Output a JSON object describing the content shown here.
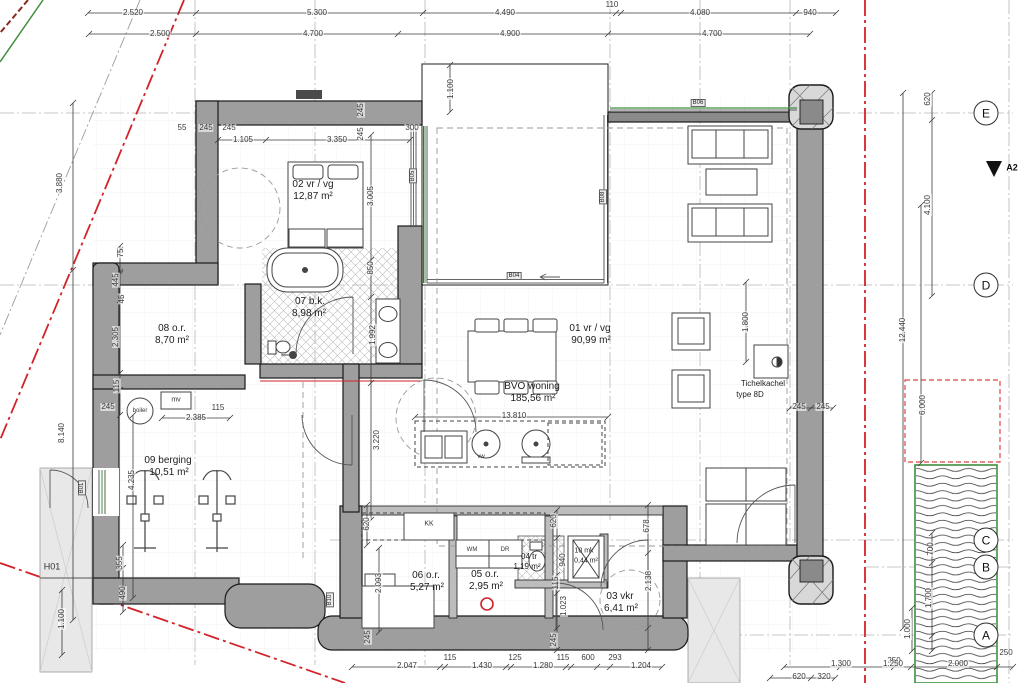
{
  "drawing": {
    "type": "architectural-floor-plan",
    "grid_axes": [
      "E",
      "D",
      "C",
      "B",
      "A"
    ],
    "section_marker": "A2",
    "window_tags": [
      "B01",
      "B04",
      "B05",
      "B06",
      "B08",
      "B10"
    ],
    "colors": {
      "boundary_red": "#d2232a",
      "vegetation_green": "#3d8f3d",
      "wall_grey": "#9e9e9e"
    },
    "rooms": [
      {
        "number": "01",
        "label": "vr / vg",
        "area": "90,99 m²"
      },
      {
        "number": "02",
        "label": "vr / vg",
        "area": "12,87 m²"
      },
      {
        "number": "03",
        "label": "vkr",
        "area": "6,41 m²"
      },
      {
        "number": "04",
        "label": "tr",
        "area": "1,19 m²"
      },
      {
        "number": "05",
        "label": "o.r.",
        "area": "2,95 m²"
      },
      {
        "number": "06",
        "label": "o.r.",
        "area": "5,27 m²"
      },
      {
        "number": "07",
        "label": "b.k.",
        "area": "8,98 m²"
      },
      {
        "number": "08",
        "label": "o.r.",
        "area": "8,70 m²"
      },
      {
        "number": "09",
        "label": "berging",
        "area": "10,51 m²"
      },
      {
        "number": "10",
        "label": "mk",
        "area": "0,44 m²"
      },
      {
        "number": "BVO",
        "label": "woning",
        "area": "185,56 m²"
      }
    ],
    "annotations": [
      {
        "t": "2.520",
        "x": 133,
        "y": 13,
        "k": "dim"
      },
      {
        "t": "5.300",
        "x": 317,
        "y": 13,
        "k": "dim"
      },
      {
        "t": "4.490",
        "x": 505,
        "y": 13,
        "k": "dim"
      },
      {
        "t": "110",
        "x": 612,
        "y": 5,
        "k": "dim"
      },
      {
        "t": "4.080",
        "x": 700,
        "y": 13,
        "k": "dim"
      },
      {
        "t": "940",
        "x": 810,
        "y": 13,
        "k": "dim"
      },
      {
        "t": "2.500",
        "x": 160,
        "y": 34,
        "k": "dim"
      },
      {
        "t": "4.700",
        "x": 313,
        "y": 34,
        "k": "dim"
      },
      {
        "t": "4.900",
        "x": 510,
        "y": 34,
        "k": "dim"
      },
      {
        "t": "4.700",
        "x": 712,
        "y": 34,
        "k": "dim"
      },
      {
        "t": "620",
        "x": 928,
        "y": 99,
        "k": "dim",
        "r": 1
      },
      {
        "t": "4.100",
        "x": 928,
        "y": 205,
        "k": "dim",
        "r": 1
      },
      {
        "t": "12.440",
        "x": 903,
        "y": 330,
        "k": "dim",
        "r": 1
      },
      {
        "t": "6.000",
        "x": 923,
        "y": 405,
        "k": "dim",
        "r": 1
      },
      {
        "t": "700",
        "x": 931,
        "y": 549,
        "k": "dim",
        "r": 1
      },
      {
        "t": "1.700",
        "x": 929,
        "y": 598,
        "k": "dim",
        "r": 1
      },
      {
        "t": "1.000",
        "x": 908,
        "y": 629,
        "k": "dim",
        "r": 1
      },
      {
        "t": "250",
        "x": 894,
        "y": 661,
        "k": "dim"
      },
      {
        "t": "2.000",
        "x": 958,
        "y": 664,
        "k": "dim"
      },
      {
        "t": "250",
        "x": 1006,
        "y": 653,
        "k": "dim"
      },
      {
        "t": "1.300",
        "x": 841,
        "y": 664,
        "k": "dim"
      },
      {
        "t": "1.250",
        "x": 893,
        "y": 664,
        "k": "dim"
      },
      {
        "t": "620",
        "x": 799,
        "y": 677,
        "k": "dim"
      },
      {
        "t": "320",
        "x": 824,
        "y": 677,
        "k": "dim"
      },
      {
        "t": "3.880",
        "x": 60,
        "y": 183,
        "k": "dim",
        "r": 1
      },
      {
        "t": "8.140",
        "x": 62,
        "y": 433,
        "k": "dim",
        "r": 1
      },
      {
        "t": "75",
        "x": 121,
        "y": 253,
        "k": "dim",
        "r": 1
      },
      {
        "t": "445",
        "x": 116,
        "y": 280,
        "k": "dim",
        "r": 1
      },
      {
        "t": "45",
        "x": 122,
        "y": 299,
        "k": "dim",
        "r": 1
      },
      {
        "t": "2.305",
        "x": 116,
        "y": 337,
        "k": "dim",
        "r": 1
      },
      {
        "t": "115",
        "x": 117,
        "y": 386,
        "k": "dim",
        "r": 1
      },
      {
        "t": "245",
        "x": 108,
        "y": 407,
        "k": "dim"
      },
      {
        "t": "2.385",
        "x": 196,
        "y": 418,
        "k": "dim"
      },
      {
        "t": "115",
        "x": 218,
        "y": 408,
        "k": "dim"
      },
      {
        "t": "4.235",
        "x": 132,
        "y": 480,
        "k": "dim",
        "r": 1
      },
      {
        "t": "355",
        "x": 120,
        "y": 563,
        "k": "dim",
        "r": 1
      },
      {
        "t": "490",
        "x": 123,
        "y": 593,
        "k": "dim",
        "r": 1
      },
      {
        "t": "1.100",
        "x": 62,
        "y": 619,
        "k": "dim",
        "r": 1
      },
      {
        "t": "55",
        "x": 182,
        "y": 128,
        "k": "dim"
      },
      {
        "t": "245",
        "x": 206,
        "y": 128,
        "k": "dim"
      },
      {
        "t": "245",
        "x": 229,
        "y": 128,
        "k": "dim"
      },
      {
        "t": "1.105",
        "x": 243,
        "y": 140,
        "k": "dim"
      },
      {
        "t": "3.350",
        "x": 337,
        "y": 140,
        "k": "dim"
      },
      {
        "t": "245",
        "x": 361,
        "y": 110,
        "k": "dim",
        "r": 1
      },
      {
        "t": "245",
        "x": 361,
        "y": 134,
        "k": "dim",
        "r": 1
      },
      {
        "t": "300",
        "x": 412,
        "y": 128,
        "k": "dim"
      },
      {
        "t": "1.100",
        "x": 451,
        "y": 89,
        "k": "dim",
        "r": 1
      },
      {
        "t": "3.005",
        "x": 371,
        "y": 196,
        "k": "dim",
        "r": 1
      },
      {
        "t": "850",
        "x": 371,
        "y": 268,
        "k": "dim",
        "r": 1
      },
      {
        "t": "1.992",
        "x": 373,
        "y": 335,
        "k": "dim",
        "r": 1
      },
      {
        "t": "3.220",
        "x": 377,
        "y": 440,
        "k": "dim",
        "r": 1
      },
      {
        "t": "13.810",
        "x": 514,
        "y": 416,
        "k": "dim"
      },
      {
        "t": "1.800",
        "x": 746,
        "y": 322,
        "k": "dim",
        "r": 1
      },
      {
        "t": "245",
        "x": 799,
        "y": 407,
        "k": "dim"
      },
      {
        "t": "245",
        "x": 823,
        "y": 407,
        "k": "dim"
      },
      {
        "t": "620",
        "x": 367,
        "y": 524,
        "k": "dim",
        "r": 1
      },
      {
        "t": "620",
        "x": 554,
        "y": 521,
        "k": "dim",
        "r": 1
      },
      {
        "t": "678",
        "x": 647,
        "y": 526,
        "k": "dim",
        "r": 1
      },
      {
        "t": "2.093",
        "x": 379,
        "y": 583,
        "k": "dim",
        "r": 1
      },
      {
        "t": "2.138",
        "x": 649,
        "y": 581,
        "k": "dim",
        "r": 1
      },
      {
        "t": "940",
        "x": 563,
        "y": 560,
        "k": "dim",
        "r": 1
      },
      {
        "t": "115",
        "x": 556,
        "y": 583,
        "k": "dim",
        "r": 1
      },
      {
        "t": "1.023",
        "x": 564,
        "y": 606,
        "k": "dim",
        "r": 1
      },
      {
        "t": "245",
        "x": 368,
        "y": 637,
        "k": "dim",
        "r": 1
      },
      {
        "t": "245",
        "x": 554,
        "y": 640,
        "k": "dim",
        "r": 1
      },
      {
        "t": "2.047",
        "x": 407,
        "y": 666,
        "k": "dim"
      },
      {
        "t": "115",
        "x": 450,
        "y": 658,
        "k": "dim"
      },
      {
        "t": "1.430",
        "x": 482,
        "y": 666,
        "k": "dim"
      },
      {
        "t": "125",
        "x": 515,
        "y": 658,
        "k": "dim"
      },
      {
        "t": "1.280",
        "x": 543,
        "y": 666,
        "k": "dim"
      },
      {
        "t": "115",
        "x": 563,
        "y": 658,
        "k": "dim"
      },
      {
        "t": "600",
        "x": 588,
        "y": 658,
        "k": "dim"
      },
      {
        "t": "293",
        "x": 615,
        "y": 658,
        "k": "dim"
      },
      {
        "t": "1.204",
        "x": 641,
        "y": 666,
        "k": "dim"
      },
      {
        "t": "02 vr / vg",
        "x": 313,
        "y": 185,
        "k": "room"
      },
      {
        "t": "12,87 m²",
        "x": 313,
        "y": 197,
        "k": "area"
      },
      {
        "t": "07 b.k.",
        "x": 310,
        "y": 302,
        "k": "room"
      },
      {
        "t": "8,98 m²",
        "x": 309,
        "y": 314,
        "k": "area"
      },
      {
        "t": "08 o.r.",
        "x": 172,
        "y": 329,
        "k": "room"
      },
      {
        "t": "8,70 m²",
        "x": 172,
        "y": 341,
        "k": "area"
      },
      {
        "t": "09 berging",
        "x": 168,
        "y": 461,
        "k": "room"
      },
      {
        "t": "10,51 m²",
        "x": 169,
        "y": 473,
        "k": "area"
      },
      {
        "t": "01 vr / vg",
        "x": 590,
        "y": 329,
        "k": "room"
      },
      {
        "t": "90,99 m²",
        "x": 591,
        "y": 341,
        "k": "area"
      },
      {
        "t": "BVO woning",
        "x": 532,
        "y": 387,
        "k": "room"
      },
      {
        "t": "185,56 m²",
        "x": 533,
        "y": 399,
        "k": "area"
      },
      {
        "t": "06 o.r.",
        "x": 426,
        "y": 576,
        "k": "room"
      },
      {
        "t": "5,27 m²",
        "x": 427,
        "y": 588,
        "k": "area"
      },
      {
        "t": "05 o.r.",
        "x": 485,
        "y": 575,
        "k": "room"
      },
      {
        "t": "2,95 m²",
        "x": 486,
        "y": 587,
        "k": "area"
      },
      {
        "t": "04 tr",
        "x": 529,
        "y": 557,
        "k": "room",
        "s": 8
      },
      {
        "t": "1,19 m²",
        "x": 527,
        "y": 567,
        "k": "area",
        "s": 8
      },
      {
        "t": "10 mk",
        "x": 584,
        "y": 551,
        "k": "room",
        "s": 7
      },
      {
        "t": "0,44 m²",
        "x": 586,
        "y": 561,
        "k": "area",
        "s": 7
      },
      {
        "t": "03 vkr",
        "x": 620,
        "y": 597,
        "k": "room"
      },
      {
        "t": "6,41 m²",
        "x": 621,
        "y": 609,
        "k": "area"
      },
      {
        "t": "Tichelkachel",
        "x": 763,
        "y": 384,
        "k": "room",
        "s": 8
      },
      {
        "t": "type 8D",
        "x": 750,
        "y": 395,
        "k": "room",
        "s": 8
      },
      {
        "t": "mv",
        "x": 176,
        "y": 400,
        "k": "fix"
      },
      {
        "t": "boiler",
        "x": 140,
        "y": 411,
        "k": "fix",
        "s": 6
      },
      {
        "t": "vw",
        "x": 481,
        "y": 457,
        "k": "fix",
        "s": 6
      },
      {
        "t": "WM",
        "x": 472,
        "y": 550,
        "k": "fix",
        "s": 6
      },
      {
        "t": "DR",
        "x": 505,
        "y": 550,
        "k": "fix",
        "s": 6
      },
      {
        "t": "KK",
        "x": 429,
        "y": 524,
        "k": "fix"
      },
      {
        "t": "H01",
        "x": 52,
        "y": 567,
        "k": "fix",
        "s": 9
      },
      {
        "t": "B06",
        "x": 698,
        "y": 103,
        "k": "tag"
      },
      {
        "t": "B05",
        "x": 413,
        "y": 176,
        "k": "tag",
        "r": 1
      },
      {
        "t": "B04",
        "x": 514,
        "y": 276,
        "k": "tag"
      },
      {
        "t": "B08",
        "x": 603,
        "y": 197,
        "k": "tag",
        "r": 1
      },
      {
        "t": "B01",
        "x": 82,
        "y": 488,
        "k": "tag",
        "r": 1
      },
      {
        "t": "B10",
        "x": 330,
        "y": 600,
        "k": "tag",
        "r": 1
      },
      {
        "t": "E",
        "x": 986,
        "y": 113,
        "k": "gridmark"
      },
      {
        "t": "D",
        "x": 986,
        "y": 285,
        "k": "gridmark"
      },
      {
        "t": "C",
        "x": 986,
        "y": 540,
        "k": "gridmark"
      },
      {
        "t": "B",
        "x": 986,
        "y": 567,
        "k": "gridmark"
      },
      {
        "t": "A",
        "x": 986,
        "y": 635,
        "k": "gridmark"
      },
      {
        "t": "A2",
        "x": 1012,
        "y": 168,
        "k": "marker"
      }
    ],
    "dimension_lines": [
      {
        "o": "h",
        "y": 13,
        "x1": 88,
        "x2": 836,
        "ticks": [
          88,
          196,
          423,
          616,
          621,
          796,
          836
        ]
      },
      {
        "o": "h",
        "y": 34,
        "x1": 89,
        "x2": 810,
        "ticks": [
          89,
          196,
          398,
          608,
          810
        ]
      },
      {
        "o": "v",
        "x": 73,
        "y1": 103,
        "y2": 620,
        "ticks": [
          103,
          270,
          620
        ]
      },
      {
        "o": "v",
        "x": 903,
        "y1": 93,
        "y2": 628,
        "ticks": [
          93,
          628
        ]
      },
      {
        "o": "v",
        "x": 921,
        "y1": 205,
        "y2": 463,
        "ticks": [
          205,
          463
        ]
      },
      {
        "o": "v",
        "x": 932,
        "y1": 93,
        "y2": 296,
        "ticks": [
          93,
          120,
          296
        ]
      },
      {
        "o": "v",
        "x": 932,
        "y1": 533,
        "y2": 651,
        "ticks": [
          533,
          563,
          636,
          651
        ]
      },
      {
        "o": "v",
        "x": 912,
        "y1": 608,
        "y2": 651,
        "ticks": [
          608,
          651
        ]
      },
      {
        "o": "h",
        "y": 667,
        "x1": 352,
        "x2": 662,
        "ticks": [
          352,
          440,
          445,
          506,
          511,
          566,
          571,
          597,
          610,
          662
        ]
      },
      {
        "o": "h",
        "y": 667,
        "x1": 784,
        "x2": 1013,
        "ticks": [
          784,
          840,
          894,
          911,
          997,
          1013
        ]
      },
      {
        "o": "h",
        "y": 678,
        "x1": 770,
        "x2": 835,
        "ticks": [
          770,
          811,
          835
        ]
      },
      {
        "o": "v",
        "x": 120,
        "y1": 246,
        "y2": 415,
        "ticks": [
          246,
          250,
          272,
          274,
          300,
          373,
          390,
          415
        ]
      },
      {
        "o": "v",
        "x": 133,
        "y1": 415,
        "y2": 598,
        "ticks": [
          415,
          598
        ]
      },
      {
        "o": "v",
        "x": 371,
        "y1": 135,
        "y2": 520,
        "ticks": [
          135,
          260,
          297,
          383,
          520
        ]
      },
      {
        "o": "v",
        "x": 450,
        "y1": 65,
        "y2": 112,
        "ticks": [
          65,
          112
        ]
      },
      {
        "o": "h",
        "y": 140,
        "x1": 218,
        "x2": 410,
        "ticks": [
          218,
          266,
          410
        ]
      },
      {
        "o": "v",
        "x": 746,
        "y1": 282,
        "y2": 362,
        "ticks": [
          282,
          362
        ]
      },
      {
        "o": "h",
        "y": 417,
        "x1": 415,
        "x2": 608,
        "ticks": [
          415,
          608
        ]
      },
      {
        "o": "h",
        "y": 408,
        "x1": 790,
        "x2": 833,
        "ticks": [
          790,
          811,
          833
        ]
      },
      {
        "o": "h",
        "y": 418,
        "x1": 162,
        "x2": 230,
        "ticks": [
          162,
          230
        ]
      },
      {
        "o": "v",
        "x": 557,
        "y1": 510,
        "y2": 650,
        "ticks": [
          510,
          538,
          575,
          593,
          628,
          650
        ]
      },
      {
        "o": "v",
        "x": 648,
        "y1": 505,
        "y2": 650,
        "ticks": [
          505,
          553,
          628,
          650
        ]
      },
      {
        "o": "v",
        "x": 62,
        "y1": 590,
        "y2": 655,
        "ticks": [
          590,
          655
        ]
      },
      {
        "o": "v",
        "x": 123,
        "y1": 545,
        "y2": 612,
        "ticks": [
          545,
          568,
          588,
          612
        ]
      },
      {
        "o": "v",
        "x": 367,
        "y1": 505,
        "y2": 545,
        "ticks": [
          505,
          545
        ]
      },
      {
        "o": "v",
        "x": 379,
        "y1": 548,
        "y2": 632,
        "ticks": [
          548,
          632
        ]
      }
    ]
  }
}
